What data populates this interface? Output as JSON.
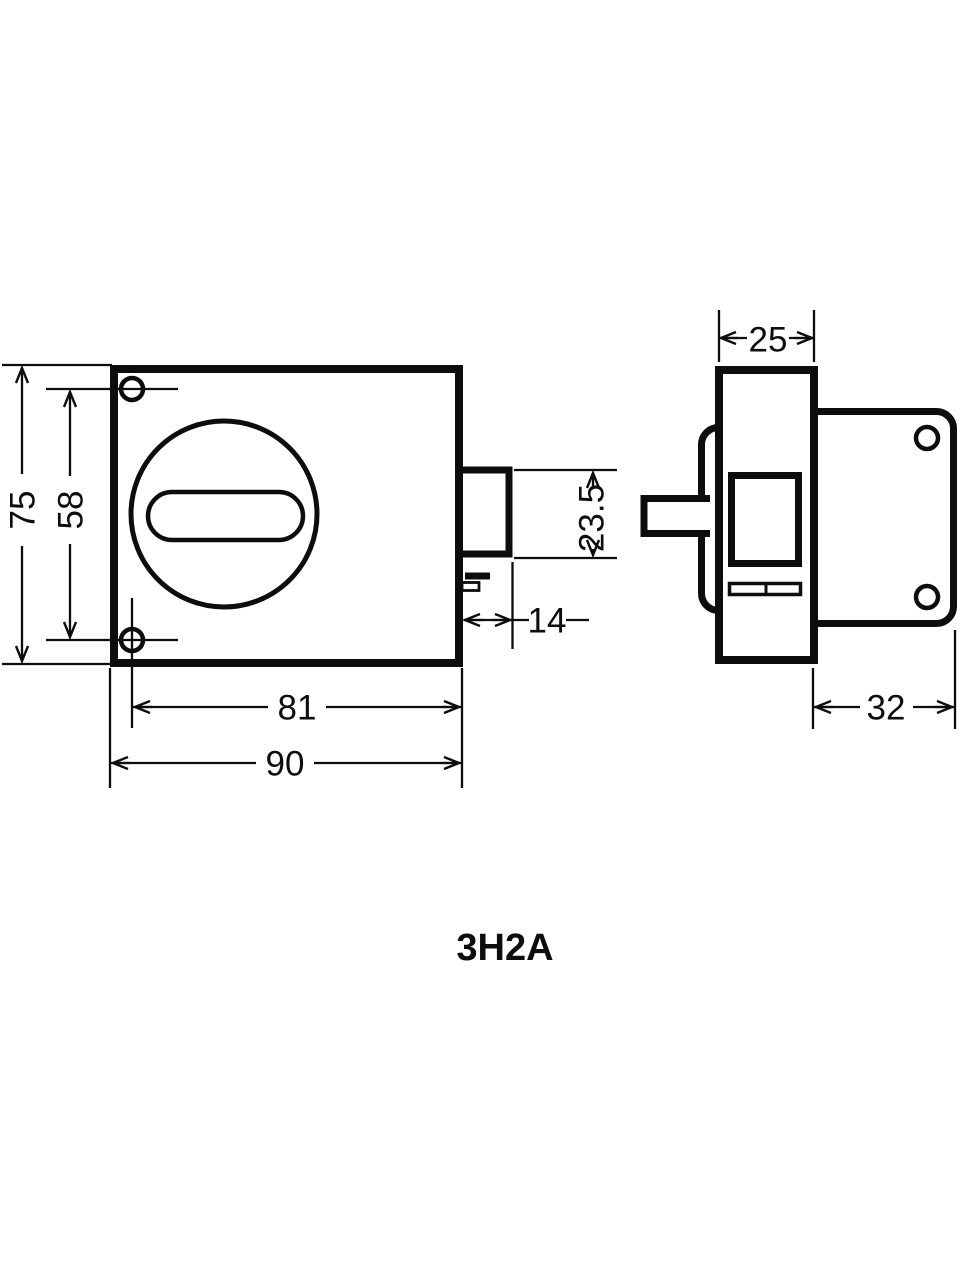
{
  "drawing": {
    "model": "3H2A",
    "dims": {
      "overall_height": "75",
      "hole_spacing": "58",
      "bolt_height": "23.5",
      "bolt_throw": "14",
      "hole_to_right_edge": "81",
      "overall_width": "90",
      "case_depth": "25",
      "plate_depth": "32"
    },
    "colors": {
      "line": "#0d0d0d",
      "background": "#ffffff"
    }
  }
}
